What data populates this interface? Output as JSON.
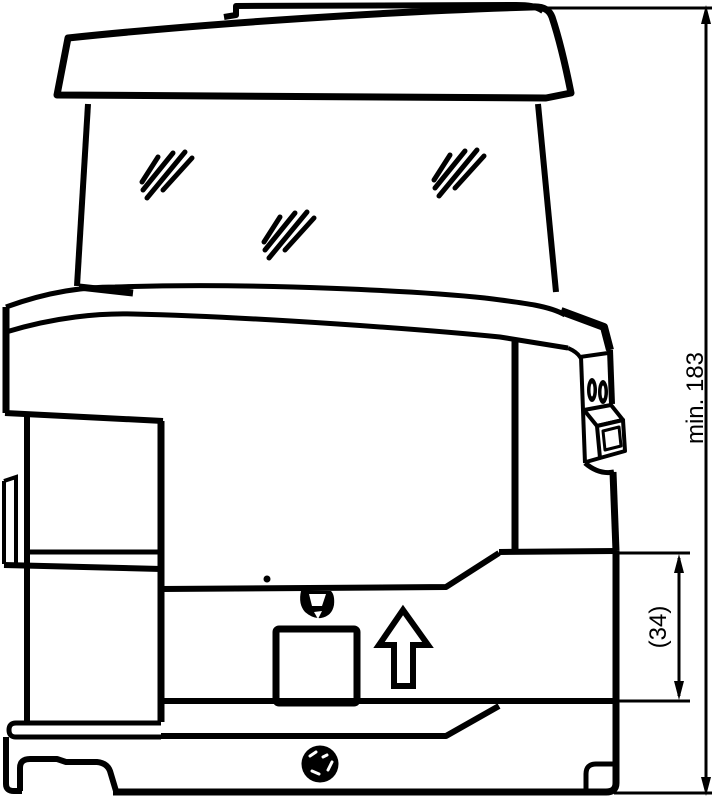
{
  "figure": {
    "type": "technical-line-drawing",
    "subject": "appliance side-view installation diagram with clearance dimensions",
    "background_color": "#ffffff",
    "line_color": "#000000"
  },
  "dimensions": {
    "height_clearance": {
      "label": "min. 183",
      "orientation": "vertical",
      "side": "right"
    },
    "base_height": {
      "label": "(34)",
      "orientation": "vertical",
      "side": "right"
    }
  },
  "annotations": {
    "direction_arrow": "up"
  },
  "parts": {
    "lid": "top lid",
    "hopper": "transparent container with shine marks",
    "switch": "side power switch with two screws",
    "pedestal": "cup platform",
    "screw": "base screw",
    "nozzle": "drip nozzle"
  }
}
